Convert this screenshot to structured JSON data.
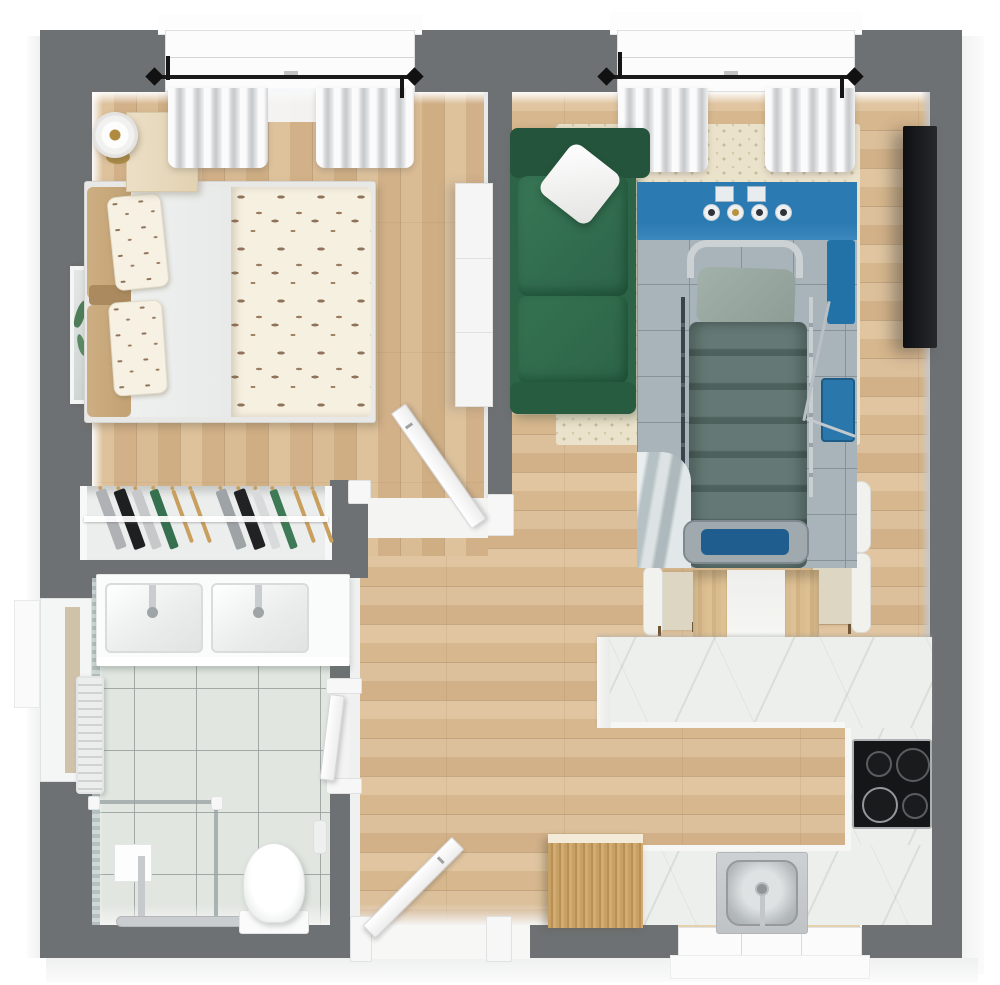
{
  "title": "apartment-3d-floor-plan-top-view",
  "colors": {
    "wall": "#6e7173",
    "wood": "#d9bc95",
    "tile": "#e1e6e0",
    "marble": "#edefec",
    "rug": "#ebe2cb",
    "sofa": "#2d6448",
    "overlay-blue": "#2b7ab2",
    "blanket": "#5a716c",
    "counter-trim": "#f6f6f4",
    "cooktop": "#151618",
    "cabinet-wood": "#c7a066"
  },
  "rooms": [
    {
      "name": "bedroom"
    },
    {
      "name": "living-room"
    },
    {
      "name": "kitchen"
    },
    {
      "name": "bathroom"
    },
    {
      "name": "hallway"
    },
    {
      "name": "wardrobe-closet"
    }
  ],
  "furniture": {
    "bedroom": [
      "double-bed-with-bird-pattern-duvet",
      "two-pillows",
      "tan-headboard-cushions",
      "nightstand",
      "table-lamp",
      "leaning-mirror",
      "white-dresser",
      "window-with-gray-curtains",
      "black-curtain-rod",
      "open-door"
    ],
    "living_room": [
      "green-sofa",
      "white-throw-pillow",
      "cream-dotted-rug",
      "wall-mounted-tv",
      "window-with-gray-curtains",
      "black-curtain-rod",
      "hospital-bed-photo-overlay"
    ],
    "dining": [
      "wood-table-with-white-runner",
      "white-chair-left",
      "white-chair-right-upper",
      "white-chair-right-lower"
    ],
    "kitchen": [
      "marble-peninsula-counter",
      "marble-right-counter",
      "marble-bottom-counter",
      "black-cooktop-4-burners",
      "stainless-sink",
      "window-under-sink",
      "wood-cabinet"
    ],
    "bathroom": [
      "double-sink-vanity",
      "two-chrome-faucets",
      "walk-in-shower-glass",
      "shower-column",
      "toilet",
      "toilet-brush-holder",
      "radiator",
      "left-wall-window",
      "tiled-floor",
      "door-to-hallway"
    ],
    "hallway": [
      "entrance-door-open"
    ]
  },
  "overlay_details": {
    "description": "photo overlay of hospital room with bed",
    "elements": [
      "blue-wall-band",
      "two-light-switches",
      "four-round-gauges",
      "chrome-headboard",
      "pillow",
      "teal-blanket",
      "side-rails",
      "footboard-with-blue-pad",
      "blue-equipment-right",
      "gray-tile-floor",
      "gray-curtain-folds"
    ]
  },
  "closet_garments": [
    {
      "name": "garment-gray",
      "style": {
        "left": "8px",
        "width": "11px",
        "background": "#aeb2b4"
      }
    },
    {
      "name": "garment-black",
      "style": {
        "left": "26px",
        "width": "12px",
        "background": "#1d1f21"
      }
    },
    {
      "name": "garment-light",
      "style": {
        "left": "44px",
        "width": "10px",
        "background": "#c6c8c9"
      }
    },
    {
      "name": "garment-green",
      "style": {
        "left": "62px",
        "width": "9px",
        "background": "#35704f"
      }
    },
    {
      "name": "empty-hanger",
      "style": {
        "left": "84px",
        "width": "4px",
        "background": "#c99f5e",
        "height": "56px"
      }
    },
    {
      "name": "empty-hanger",
      "style": {
        "left": "102px",
        "width": "4px",
        "background": "#c99f5e",
        "height": "56px"
      }
    },
    {
      "name": "garment-gray",
      "style": {
        "left": "128px",
        "width": "11px",
        "background": "#9ea3a6"
      }
    },
    {
      "name": "garment-black",
      "style": {
        "left": "146px",
        "width": "12px",
        "background": "#202224"
      }
    },
    {
      "name": "garment-white",
      "style": {
        "left": "164px",
        "width": "9px",
        "background": "#d9dadb"
      }
    },
    {
      "name": "garment-green",
      "style": {
        "left": "182px",
        "width": "8px",
        "background": "#3d7a55"
      }
    },
    {
      "name": "empty-hanger",
      "style": {
        "left": "206px",
        "width": "4px",
        "background": "#c99f5e",
        "height": "56px"
      }
    },
    {
      "name": "empty-hanger",
      "style": {
        "left": "224px",
        "width": "4px",
        "background": "#c99f5e",
        "height": "56px"
      }
    }
  ],
  "cooktop_burners": [
    {
      "name": "burner-small-tl",
      "style": {
        "left": "12px",
        "top": "10px",
        "width": "22px",
        "height": "22px"
      }
    },
    {
      "name": "burner-large-tr",
      "style": {
        "left": "42px",
        "top": "7px",
        "width": "30px",
        "height": "30px"
      }
    },
    {
      "name": "burner-large-bl",
      "style": {
        "left": "8px",
        "top": "46px",
        "width": "32px",
        "height": "32px",
        "borderColor": "#93979a"
      }
    },
    {
      "name": "burner-small-br",
      "style": {
        "left": "48px",
        "top": "52px",
        "width": "22px",
        "height": "22px"
      }
    }
  ],
  "overlay_gauges": [
    {
      "name": "gauge",
      "style": {
        "left": "66px",
        "top": "22px",
        "color": "#2f343b"
      }
    },
    {
      "name": "gauge",
      "style": {
        "left": "90px",
        "top": "22px",
        "color": "#b8923f"
      }
    },
    {
      "name": "gauge",
      "style": {
        "left": "114px",
        "top": "22px",
        "color": "#2f343b"
      }
    },
    {
      "name": "gauge",
      "style": {
        "left": "138px",
        "top": "22px",
        "color": "#2f343b"
      }
    }
  ]
}
